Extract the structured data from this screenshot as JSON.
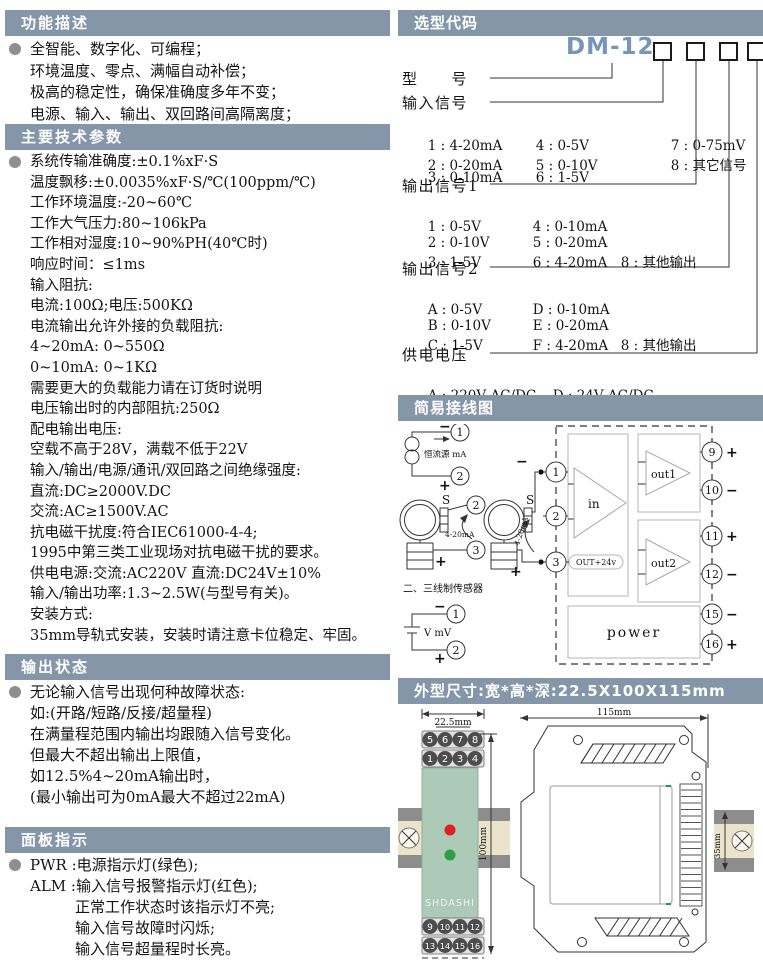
{
  "left": {
    "function": {
      "title": "功能描述",
      "lines": [
        "全智能、数字化、可编程；",
        "环境温度、零点、满幅自动补偿；",
        "极高的稳定性，确保准确度多年不变；",
        "电源、输入、输出、双回路间高隔离度；"
      ]
    },
    "parameters": {
      "title": "主要技术参数",
      "lines": [
        "系统传输准确度:±0.1%xF·S",
        "温度飘移:±0.0035%xF·S/℃(100ppm/℃)",
        "工作环境温度:-20~60℃",
        "工作大气压力:80~106kPa",
        "工作相对湿度:10~90%PH(40℃时)",
        "响应时间：≤1ms",
        "输入阻抗:",
        "电流:100Ω;电压:500KΩ",
        "电流输出允许外接的负载阻抗:",
        "4~20mA: 0~550Ω",
        "0~10mA: 0~1KΩ",
        "需要更大的负载能力请在订货时说明",
        "电压输出时的内部阻抗:250Ω",
        "配电输出电压:",
        "空载不高于28V，满载不低于22V",
        "输入/输出/电源/通讯/双回路之间绝缘强度:",
        "直流:DC≥2000V.DC",
        "交流:AC≥1500V.AC",
        "抗电磁干扰度:符合IEC61000-4-4;",
        "1995中第三类工业现场对抗电磁干扰的要求。",
        "供电电源:交流:AC220V 直流:DC24V±10%",
        "输入/输出功率:1.3~2.5W(与型号有关)。",
        "安装方式:",
        "35mm导轨式安装，安装时请注意卡位稳定、牢固。"
      ]
    },
    "output_status": {
      "title": "输出状态",
      "lines": [
        "无论输入信号出现何种故障状态:",
        "如:(开路/短路/反接/超量程)",
        "在满量程范围内输出均跟随入信号变化。",
        "但最大不超出输出上限值，",
        "如12.5%4~20mA输出时，",
        "(最小输出可为0mA最大不超过22mA)"
      ]
    },
    "panel": {
      "title": "面板指示",
      "lines": [
        "PWR :电源指示灯(绿色);",
        "ALM :输入信号报警指示灯(红色);",
        "　　　正常工作状态时该指示灯不亮;",
        "　　　输入信号故障时闪烁;",
        "　　　输入信号超量程时长亮。"
      ]
    }
  },
  "right": {
    "selection": {
      "title": "选型代码",
      "model_prefix": "DM-12-",
      "model_label": "型　　号",
      "groups": [
        {
          "label": "输入信号",
          "rows": [
            [
              "1 : 4-20mA",
              "4 : 0-5V",
              "7 : 0-75mV"
            ],
            [
              "2 : 0-20mA",
              "5 : 0-10V",
              "8 : 其它信号"
            ],
            [
              "3 : 0-10mA",
              "6 : 1-5V",
              ""
            ]
          ]
        },
        {
          "label": "输出信号1",
          "rows": [
            [
              "1 : 0-5V",
              "4 : 0-10mA",
              ""
            ],
            [
              "2 : 0-10V",
              "5 : 0-20mA",
              ""
            ],
            [
              "3 : 1-5V",
              "6 : 4-20mA",
              "8 : 其他输出"
            ]
          ]
        },
        {
          "label": "输出信号2",
          "rows": [
            [
              "A : 0-5V",
              "D : 0-10mA",
              ""
            ],
            [
              "B : 0-10V",
              "E : 0-20mA",
              ""
            ],
            [
              "C : 1-5V",
              "F : 4-20mA",
              "8 : 其他输出"
            ]
          ]
        },
        {
          "label": "供电电压",
          "rows": [
            [
              "A : 220V AC/DC",
              "D : 24V AC/DC",
              ""
            ]
          ]
        }
      ]
    },
    "wiring": {
      "title": "简易接线图",
      "source_label": "恒流源 mA",
      "sensor_note": "二、三线制传感器",
      "loop1": "4-20mA",
      "loop2": "4-20mA",
      "battery_label": "V mV",
      "s1": "S",
      "s2": "S",
      "in": "in",
      "out1": "out1",
      "out2": "out2",
      "power": "power",
      "aux": "OUT+24v",
      "minus": "−",
      "plus": "+",
      "tc1": "1",
      "tc2": "2",
      "ts1": "2",
      "ts2": "3",
      "tb1": "1",
      "tb2": "2",
      "tl1": "1",
      "tl2": "2",
      "tl3": "3",
      "tr": [
        "9",
        "10",
        "11",
        "12",
        "15",
        "16"
      ],
      "signs": [
        "+",
        "−",
        "+",
        "−",
        "−",
        "+"
      ]
    },
    "dimensions": {
      "title": "外型尺寸:宽*高*深:22.5X100X115mm",
      "width": "22.5mm",
      "height": "100mm",
      "depth": "115mm",
      "rail": "35mm",
      "brand": "SHDASHI",
      "row_top": [
        "5",
        "6",
        "7",
        "8"
      ],
      "row_top2": [
        "1",
        "2",
        "3",
        "4"
      ],
      "row_bot": [
        "9",
        "10",
        "11",
        "12"
      ],
      "row_bot2": [
        "13",
        "14",
        "15",
        "16"
      ]
    }
  }
}
